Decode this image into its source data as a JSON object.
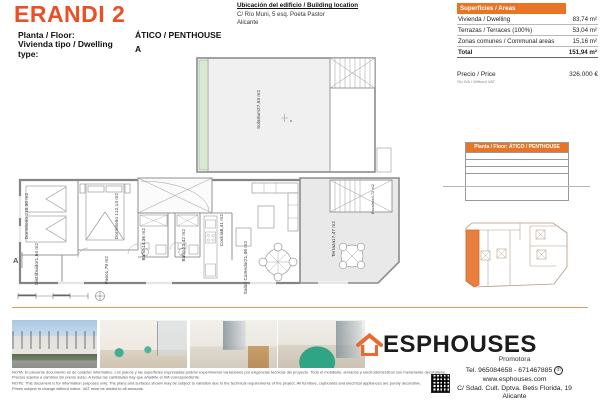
{
  "header": {
    "title": "ERANDI 2",
    "floor_label": "Planta / Floor:",
    "floor_value": "ÁTICO / PENTHOUSE",
    "type_label": "Vivienda tipo / Dwelling type:",
    "type_value": "A"
  },
  "location": {
    "heading": "Ubicación del edificio / Building location",
    "address1": "C/ Río Muni, 5 esq. Poeta Pastor",
    "address2": "Alicante"
  },
  "areas": {
    "header": "Superficies / Areas",
    "rows": [
      {
        "label": "Vivienda / Dwelling",
        "value": "83,74 m²"
      },
      {
        "label": "Terrazas / Terraces (100%)",
        "value": "53,04 m²"
      },
      {
        "label": "Zonas comunes / Communal areas",
        "value": "15,16 m²"
      }
    ],
    "total_label": "Total",
    "total_value": "151,94 m²"
  },
  "price": {
    "label": "Precio / Price",
    "sublabel": "Sin IVA / Without VAT",
    "value": "326.000 €"
  },
  "plan": {
    "section_mark": "A",
    "rooms": {
      "solarium": {
        "name": "Solarium",
        "area": "27,53 m2"
      },
      "dormitorio2": {
        "name": "Dormitorio 2",
        "area": "10,30 m2"
      },
      "dormitorio1": {
        "name": "Dormitorio 1",
        "area": "12,14 m2"
      },
      "distribuidor": {
        "name": "Distribuidor",
        "area": "1,64 m2"
      },
      "paso": {
        "name": "Paso",
        "area": "1,79 m2"
      },
      "bano1": {
        "name": "Baño 1",
        "area": "4,36 m2"
      },
      "bano2": {
        "name": "Baño 2",
        "area": "3,42 m2"
      },
      "cocina": {
        "name": "Cocina",
        "area": "8,41 m2"
      },
      "salon": {
        "name": "Salón Comedor",
        "area": "21,06 m2"
      },
      "terraza": {
        "name": "Terraza",
        "area": "17,47 m2"
      },
      "escalera": {
        "name": "Escalera",
        "area": "4,72 m2"
      }
    }
  },
  "elevation": {
    "header": "Planta / Floor: ÁTICO / PENTHOUSE"
  },
  "brand": {
    "name": "ESPHOUSES",
    "tagline": "Promotora",
    "tel": "Tel. 965084658 - 671467885",
    "web": "www.esphouses.com",
    "address1": "C/ Sdad. Cult. Dptva. Betis Florida, 19",
    "address2": "Alicante"
  },
  "icons": {
    "whatsapp": "✆"
  },
  "colors": {
    "accent_orange": "#e87425",
    "title_orange": "#ea4f25",
    "highlight_unit": "#e87f41",
    "separator": "#e09a5e"
  },
  "disclaimer": {
    "lines": [
      "NOTA: El presente documento es de carácter informativo. Los planos y las superficies expresadas podrán experimentar variaciones por exigencias técnicas del proyecto. Todo el mobiliario, armarios y electrodomésticos son meramente decorativos.",
      "Precios sujetos a cambios sin previo aviso. A todas las cantidades hay que añadirle el IVA correspondiente.",
      "NOTE: This document is for information purposes only. The plans and surfaces shown may be subject to variation due to the technical requirements of the project. All furniture, cupboards and electrical appliances are purely decorative.",
      "Prices subject to change without notice. VAT must be added to all amounts."
    ]
  }
}
